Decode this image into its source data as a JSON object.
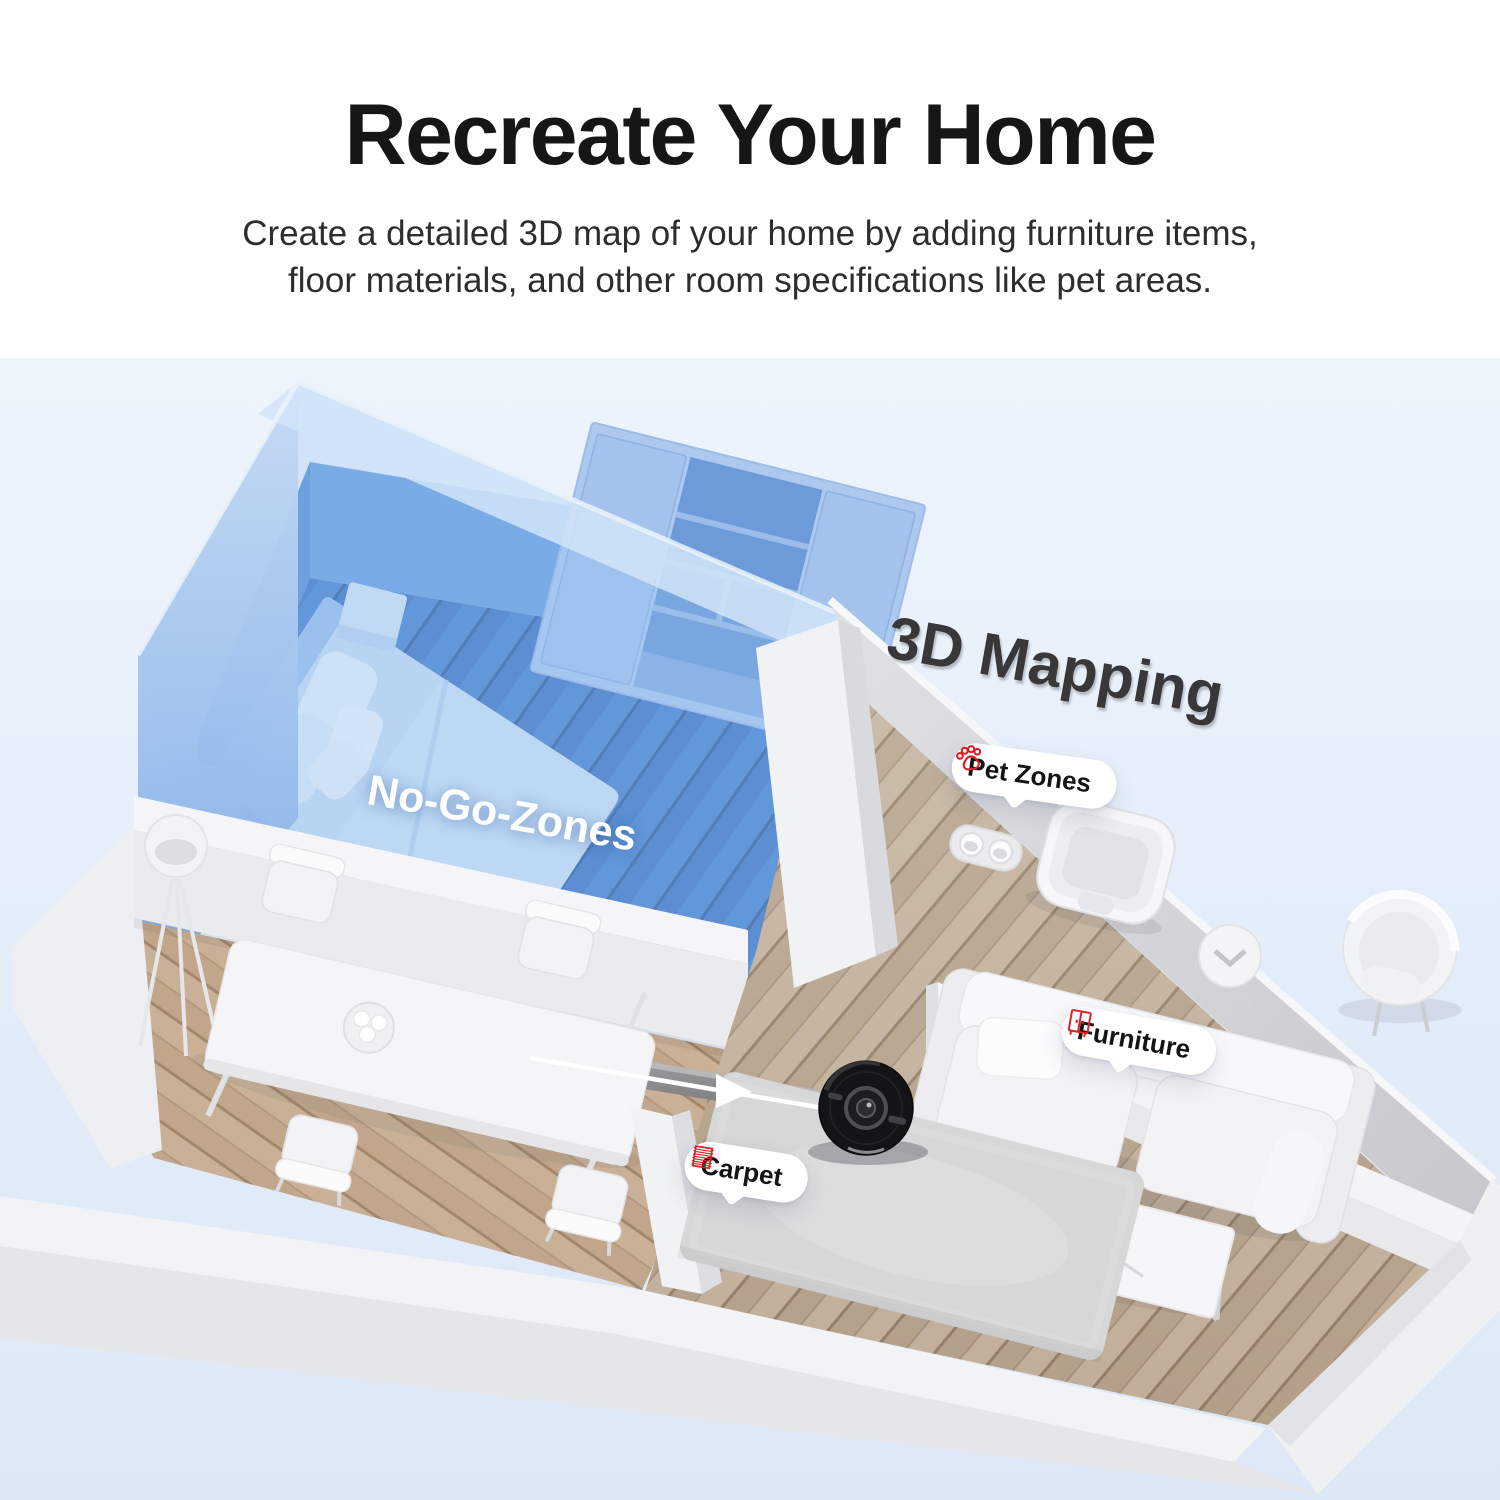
{
  "header": {
    "title": "Recreate Your Home",
    "subtitle_line1": "Create a detailed 3D map of your home by adding furniture items,",
    "subtitle_line2": "floor materials, and other room specifications like pet areas."
  },
  "scene": {
    "labels": {
      "mapping": "3D Mapping",
      "no_go_zones": "No-Go-Zones",
      "pet_zones": "Pet Zones",
      "furniture": "Furniture",
      "carpet": "Carpet"
    },
    "colors": {
      "accent_red": "#dc2128",
      "no_go_blue": "#4d86d2",
      "scene_background": "#e4eef9",
      "mapping_text": "#38383a",
      "robot_black": "#1c1c1e"
    }
  }
}
